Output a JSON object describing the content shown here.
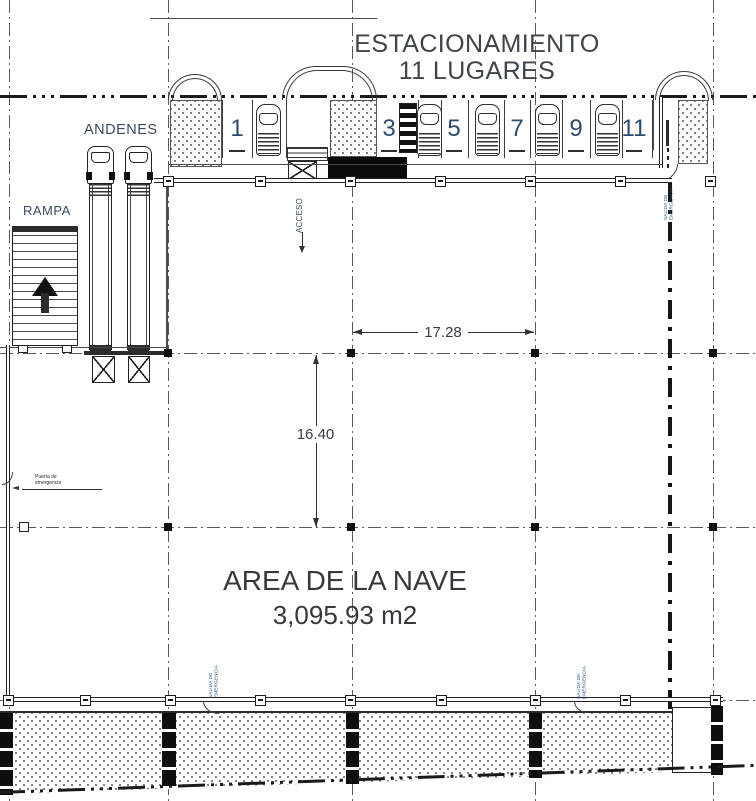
{
  "title": {
    "line1": "ESTACIONAMIENTO",
    "line2": "11 LUGARES"
  },
  "labels": {
    "andenes": "ANDENES",
    "rampa": "RAMPA",
    "acceso": "ACCESO",
    "area_name": "AREA DE LA NAVE",
    "area_value": "3,095.93 m2",
    "emergency_door": "Puerta de emergencia",
    "emergency_exit": "SALIDA DE EMERGENCIA"
  },
  "dimensions": {
    "bay_width": "17.28",
    "bay_depth": "16.40"
  },
  "parking": {
    "stalls": [
      "1",
      "3",
      "5",
      "7",
      "9",
      "11"
    ]
  },
  "colors": {
    "line": "#2e2e2e",
    "text_dark": "#3f434a",
    "stall_number": "#2d4a6d",
    "tiny_label": "#1f4e79",
    "hatch_dot": "#6a6a6a"
  }
}
